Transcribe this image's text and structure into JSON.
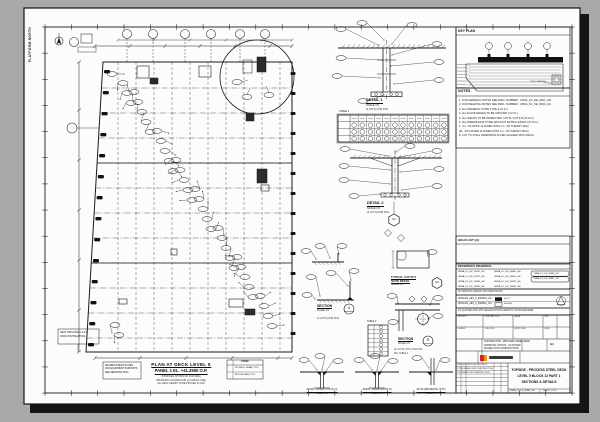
{
  "margin": {
    "north_label": "PLATFORM NORTH"
  },
  "plan": {
    "title1": "PLAN AT DECK LEVEL 5",
    "title2": "PANEL 1  EL. +41.2500 O.P.",
    "sub1": "(PROFILES SHOWN ON FAR SIDE)",
    "sub2": "(PROFILES LOCATED FOR LA CARGO LINE)",
    "sub3": "ALL DECK SEAMS TO BE PROVEN FLUSH",
    "left_note1": "WELDED INSERT PLATES",
    "left_note2": "FOR EQUIPMENT SUPPORTS",
    "left_note3": "SEE SEPARATE DWG.",
    "next_note1": "NEXT DWG PANEL 2 & 3",
    "next_note2": "(FOR CONTINUATION)",
    "legend_title": "TABLE",
    "legend_row1": "W2  WELD SEAM (TYP.)",
    "legend_row2": "FB  FLAT BAR (TYP.)"
  },
  "details": {
    "d1_label": "DETAIL 1",
    "d1_scale": "SCALE 1:5",
    "d1_note": "(2 LOC'S) FOR POS.",
    "table1_label": "TABLE 1",
    "d2_label": "DETAIL 2",
    "d2_scale": "SCALE 1:5",
    "d2_note": "(2 LOC'S) FOR POS.",
    "hex1": "H1",
    "hex2": "H2",
    "cutout1": "TYPICAL CUT-OUT",
    "cutout2": "50X50 DETAIL",
    "cutout_scale": "SCALE 1:5",
    "secA_label": "SECTION",
    "secA_bubble": "A",
    "secA_scale": "SCALE 1:5",
    "secA_note": "(2 LOC'S) FOR POS.",
    "secB_label": "SECTION",
    "secB_bubble": "B",
    "secB_scale": "SCALE 1:5",
    "secB_note": "(2 LOC'S) (TYP.) FOR POS.",
    "secB_note2": "DIA. TABLE 2",
    "table2_label": "TABLE 2",
    "w1_label": "AP200 - AP220 (T.2 LOC 3)",
    "w1_scale": "SCALE 1:5",
    "w2_label": "AP200 - AP220 (A LOC 5)",
    "w2_scale": "SCALE 1:5",
    "w3_label": "AP 50 (FB) DETAIL (TYP.)",
    "w3_scale": "SCALE 1:5"
  },
  "key_plan": {
    "label": "KEY PLAN",
    "note": "THIS DRAWING"
  },
  "notes": {
    "label": "NOTES",
    "items": [
      "1. FOR GENERAL NOTES SEE DWG. NUMBER : UNNA_FC_DE_0001_GN.",
      "2. FOR WELDING NOTES SEE DWG. NUMBER : UNNA_FC_DE_0002_GN.",
      "3. ALL MATERIAL TO BE TYPE (U.N.O.).",
      "4. ALL PLATE EDGES TO BE GROUND (U.N.O.).",
      "5. ALL WELDS TO BE INSPECTED. CAT B / CAT F-B (U.N.O.).",
      "6. ALL DIMENSIONS TO BE WITHOUT EXTRA LENGTH (U.N.O.).",
      "7. C.L. OF STIFF. ALIGNED WITH C.L. OF THEORY MLD.",
      "    (FL. ±0.5 AFTER ALIGNED WITH C.L. OF THEORY MLD.)",
      "8. CUT TO FINAL DIMENSION AFTER ALIGNED WITH DECK."
    ]
  },
  "hold": {
    "label": "HOLD LIST (H)"
  },
  "reference": {
    "label": "REFERENCE DRAWINGS",
    "items": [
      "UNNA_FC_DE_26780_GN",
      "UNNA_FC_DE_26781_GN",
      "UNNA_FC_DE_26984_GN",
      "UNNA_FC_DE_26985_GN",
      "UNNA_FC_DE_30880_GN",
      "UNNA_FC_DE_30881_GN",
      "UNNA_FC_DE_30883_GN",
      "UNNA_FC_DE_30884_GN"
    ],
    "boxed": [
      "UNNA_FC_DE_30886_GN",
      "UNNA_FC_DE_30887_GN"
    ],
    "band1": "NO SPECIFIC DESIGN DOCUMENTATION",
    "band2": "AS QUOTED AND STR. RELEVANT DOCUMENTS TO PROGRAMME"
  },
  "cert": {
    "row1": "UNNA-B1_AE3_C_0000010_GN",
    "tag1": "No.72",
    "row2": "UNNA-B1_AE3_C_0000011_GN",
    "tag2": "No.0001"
  },
  "title_block": {
    "labels": [
      "PROJECT",
      "CONTRACT No.",
      "AREA",
      "REV",
      "DRAWN",
      "CHECKED",
      "APPROVED",
      "DATE"
    ],
    "mid1": "CONTRACTOR - PROCESS STEEL DECK",
    "mid2": "APPROVAL STATUS : AS NOTED",
    "mid3": "ISSUED FOR CONSTRUCTION",
    "size": "A1",
    "rev_header": "REV  DESCRIPTION  DATE  APPD",
    "rev_row1": "P2  RE-ISSUED FOR CONSTRUCTION",
    "rev_row2": "P1  ISSUED FOR CONSTRUCTION",
    "title1": "TOPSIDE - PROCESS STEEL DECK",
    "title2": "LEVEL 5 BLOCK 12 PART 1",
    "title3": "SECTIONS & DETAILS",
    "dwg_no": "UNNA_FC_DE_30882_GN",
    "sheet": "SHEET 1 OF 1",
    "logo_colors": [
      "#d2232a",
      "#f7941d"
    ]
  }
}
